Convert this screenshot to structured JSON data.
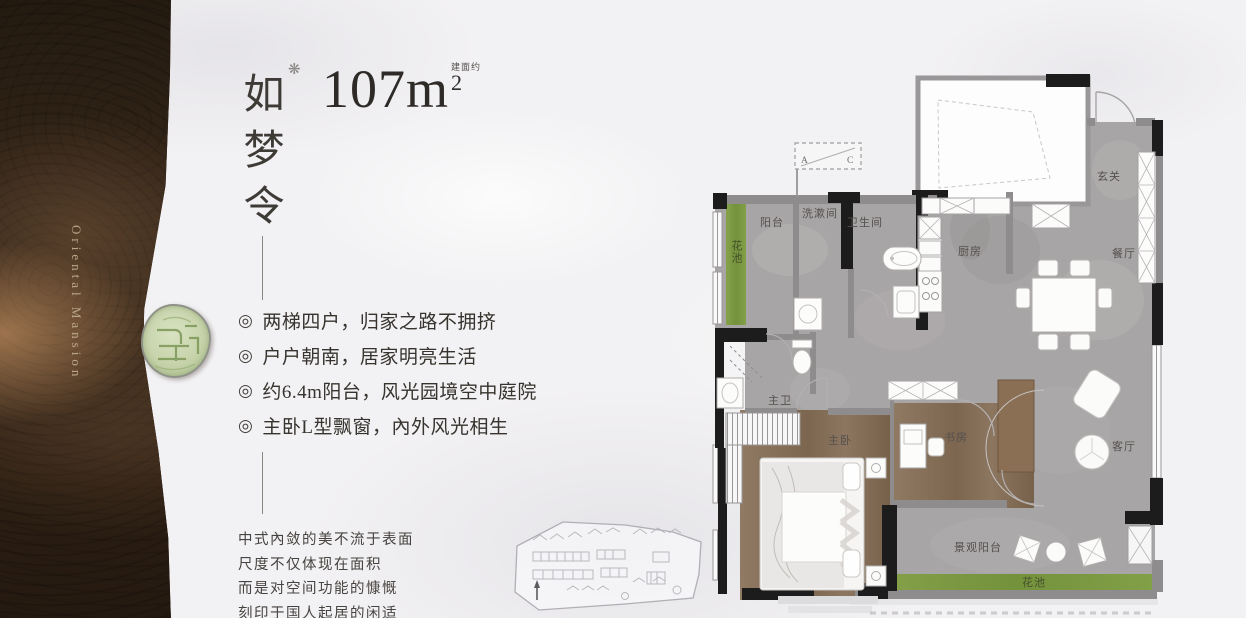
{
  "sidebar": {
    "brand": "Oriental Mansion"
  },
  "header": {
    "title_chars": [
      "如",
      "梦",
      "令"
    ],
    "ornament": "❋",
    "area": {
      "prefix": "建面约",
      "value": "107m",
      "sup": "2"
    }
  },
  "features": {
    "bullet": "◎",
    "items": [
      "两梯四户，归家之路不拥挤",
      "户户朝南，居家明亮生活",
      "约6.4m阳台，风光园境空中庭院",
      "主卧L型飘窗，內外风光相生"
    ]
  },
  "description": {
    "lines": [
      "中式內敛的美不流于表面",
      "尺度不仅体现在面积",
      "而是对空间功能的慷慨",
      "刻印于国人起居的闲适"
    ]
  },
  "floorplan": {
    "labels": {
      "entry": "玄关",
      "kitchen": "厨房",
      "dining": "餐厅",
      "living": "客厅",
      "study": "书房",
      "master_bedroom": "主卧",
      "master_bath": "主卫",
      "bathroom": "卫生间",
      "washroom": "洗漱间",
      "balcony": "阳台",
      "flower_bed_left": "花池",
      "scenic_balcony": "景观阳台",
      "flower_bed_bottom": "花池",
      "ac_a": "A",
      "ac_c": "C"
    }
  },
  "colors": {
    "sidebar_brown": "#31241a",
    "brand_gold": "#c2b091",
    "seal_green": "#c6d3aa",
    "floor_gray": "#a8a5a6",
    "wood_brown": "#85705c",
    "planter_green": "#7e9b43",
    "wall_black": "#1d1c1c",
    "text_dark": "#3c3835"
  }
}
